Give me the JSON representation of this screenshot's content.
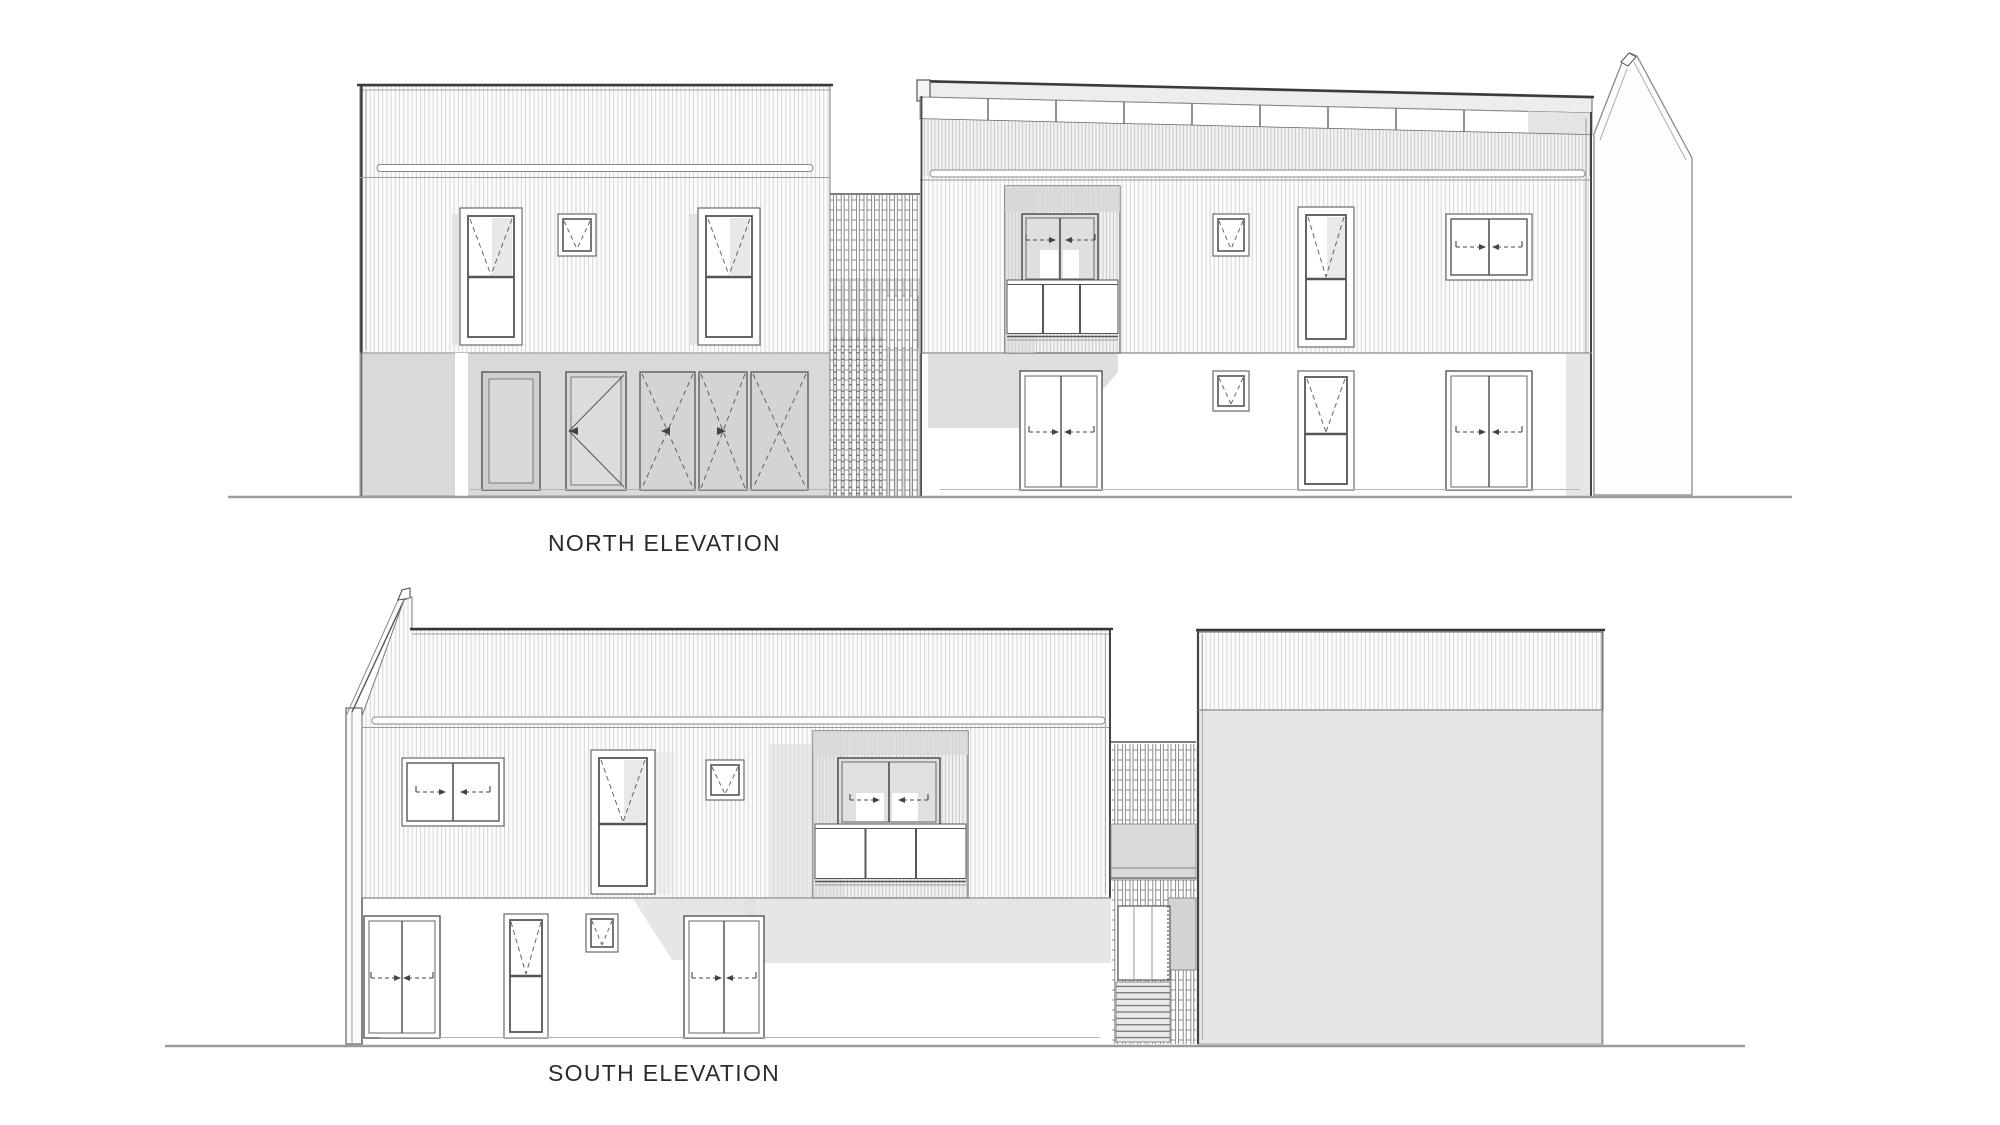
{
  "titles": {
    "north": "NORTH ELEVATION",
    "south": "SOUTH ELEVATION"
  },
  "colors": {
    "background": "#ffffff",
    "line_dark": "#3a3a3a",
    "line_mid": "#666666",
    "cladding_line": "#c9c9c9",
    "wall_gray": "#d9d9d9",
    "shadow_gray": "#dcdcdc",
    "blank_wall": "#e6e6e6",
    "ground_line": "#999999",
    "label_text": "#2b2b2b"
  },
  "annotation_key": {
    "dashed_v": "window opening direction",
    "dashed_arrows": "sliding panel direction",
    "solid_diagonals": "door swing",
    "dashed_x": "double door leaves"
  }
}
